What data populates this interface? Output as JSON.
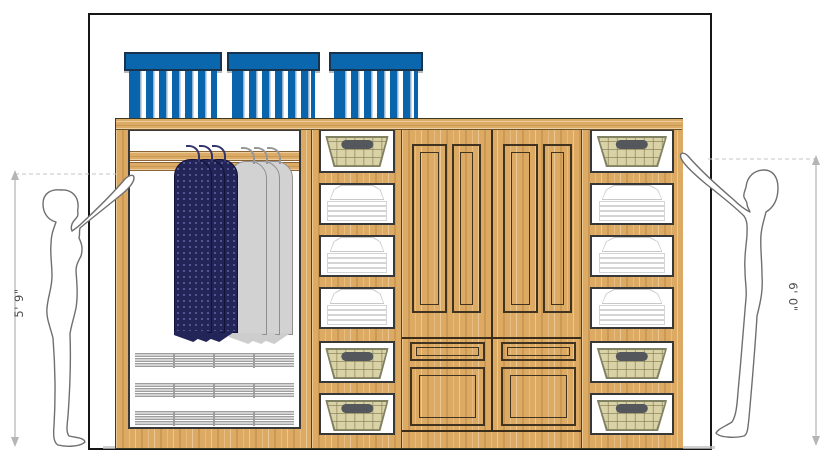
{
  "drawing": {
    "type": "closet-elevation-design",
    "wall": {
      "shape": "rectangle-outline"
    },
    "dimension_annotations": {
      "left_height_label": "5' 9\"",
      "right_height_label": "6' 0\""
    },
    "figures": [
      {
        "side": "left",
        "description": "woman standing, reaching up to closet",
        "height_label": "5' 9\""
      },
      {
        "side": "right",
        "description": "man standing, reaching up to closet",
        "height_label": "6' 0\""
      }
    ],
    "closet": {
      "top_bins": {
        "count": 3,
        "style": "blue striped canvas bins on top shelf"
      },
      "left_section": {
        "type": "hanging-rod",
        "garment_bags": [
          {
            "color_name": "navy",
            "count": 3
          },
          {
            "color_name": "gray",
            "count": 3
          }
        ],
        "pullout_racks": 3
      },
      "middle_column": {
        "cubbies": [
          "basket",
          "folded-linens",
          "folded-linens",
          "folded-linens",
          "basket",
          "basket"
        ]
      },
      "center_section": {
        "doors": 2,
        "panels_per_door": 2,
        "small_drawers": 2,
        "large_drawers": 2
      },
      "right_column": {
        "cubbies": [
          "basket",
          "folded-linens",
          "folded-linens",
          "folded-linens",
          "basket",
          "basket"
        ]
      }
    },
    "colors": {
      "bin_blue": "#0a66ad",
      "wood": "#ddaa64",
      "garment_navy": "#232457",
      "garment_gray": "#d2d2d2",
      "basket_tan": "#d8d2a6",
      "outline_dark": "#383838",
      "dimension_gray": "#b5b5b5"
    }
  }
}
